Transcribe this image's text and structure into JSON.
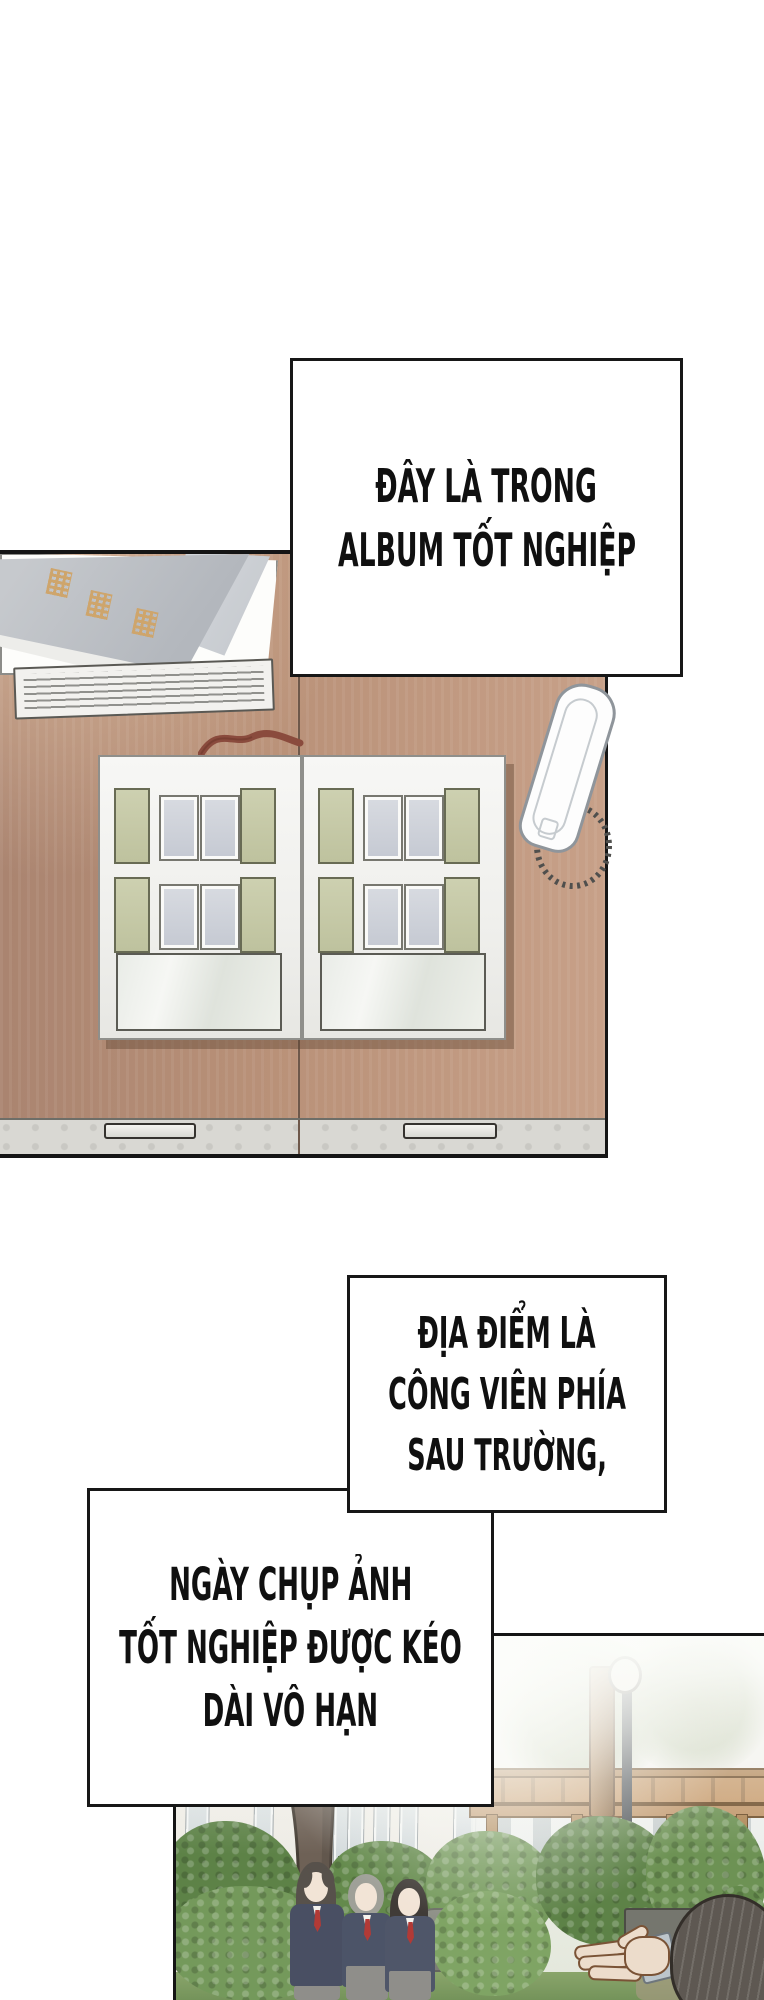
{
  "comic": {
    "type": "webtoon-page",
    "captions": [
      {
        "lines": [
          "ĐÂY LÀ TRONG",
          "ALBUM TỐT NGHIỆP"
        ]
      },
      {
        "lines": [
          "ĐỊA ĐIỂM LÀ",
          "CÔNG VIÊN PHÍA",
          "SAU TRƯỜNG,"
        ]
      },
      {
        "lines": [
          "NGÀY CHỤP ẢNH",
          "TỐT NGHIỆP ĐƯỢC KÉO",
          "DÀI VÔ HẠN"
        ]
      }
    ],
    "panels": [
      {
        "name": "desk-panel",
        "content": "wooden desk top with closed graduation album, paper pad, open photo album with empty photo slots, red ribbon bookmark, intercom handset with coiled cord"
      },
      {
        "name": "park-panel",
        "content": "misty park behind school with pergola, lamp post, tree, bushes, three uniformed students and photographer's head and raised hand"
      }
    ]
  },
  "colors": {
    "ink": "#171717",
    "paper": "#ffffff",
    "desk_wood_left": "#aa8470",
    "desk_wood_right": "#c7a088",
    "desk_front_strip": "#d9d8d3",
    "album_page": "#f5f5f2",
    "photo_slot_sage": "#c6c9a8",
    "photo_slot_gray": "#ced2da",
    "album_cover_gray": "#b9bcc1",
    "cover_title_gold": "#cfa468",
    "ribbon_red": "#8a4b3d",
    "phone_white": "#fdfdfd",
    "bush_green": "#6d9254",
    "uniform_navy": "#515a71",
    "tie_red": "#b23a36",
    "grass_green": "#7f9c63"
  }
}
